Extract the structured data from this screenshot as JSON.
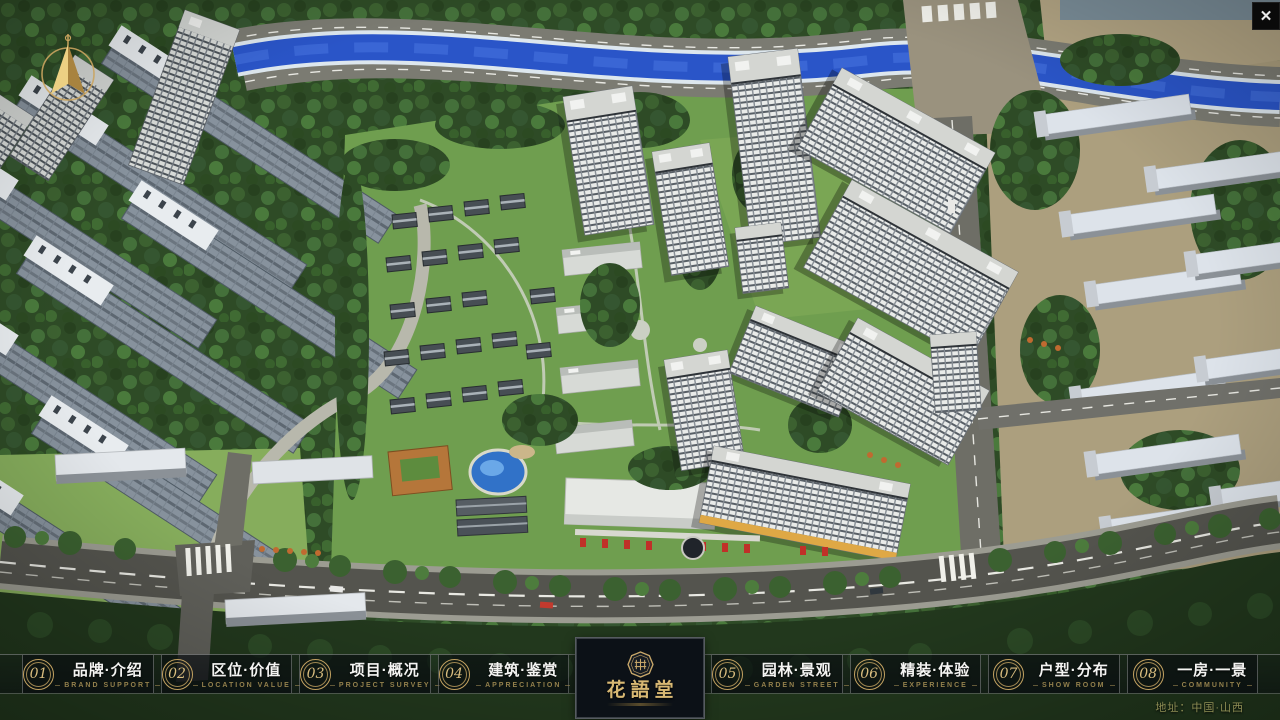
{
  "header": {
    "close_glyph": "✕"
  },
  "navbar": {
    "items": [
      {
        "num": "01",
        "zh": "品牌·介绍",
        "en": "BRAND SUPPORT"
      },
      {
        "num": "02",
        "zh": "区位·价值",
        "en": "LOCATION VALUE"
      },
      {
        "num": "03",
        "zh": "项目·概况",
        "en": "PROJECT SURVEY"
      },
      {
        "num": "04",
        "zh": "建筑·鉴赏",
        "en": "APPRECIATION"
      },
      {
        "num": "05",
        "zh": "园林·景观",
        "en": "GARDEN STREET"
      },
      {
        "num": "06",
        "zh": "精装·体验",
        "en": "EXPERIENCE"
      },
      {
        "num": "07",
        "zh": "户型·分布",
        "en": "SHOW ROOM"
      },
      {
        "num": "08",
        "zh": "一房·一景",
        "en": "COMMUNITY"
      }
    ]
  },
  "logo": {
    "title": "花語堂"
  },
  "footer": {
    "address": "地址：中国·山西"
  },
  "colors": {
    "gold": "#c3a261",
    "navbar_bg": "#0a0e12",
    "river": "#2a55c8"
  }
}
